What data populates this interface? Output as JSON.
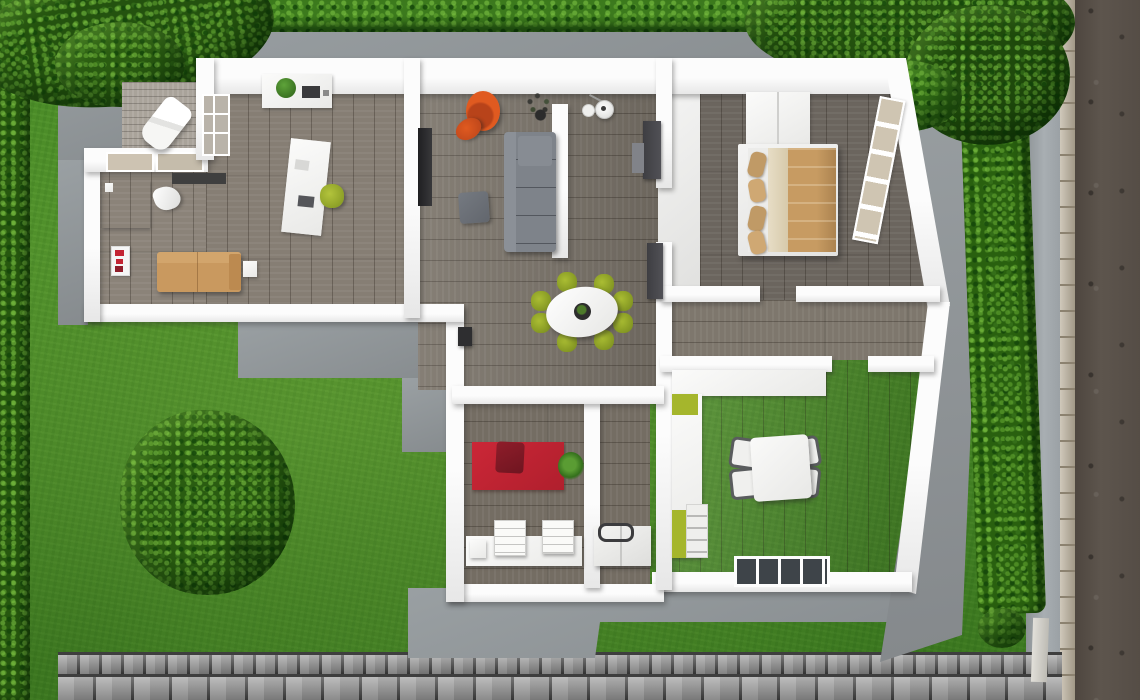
{
  "scene": {
    "kind": "3d-floor-plan-top-view"
  },
  "palette": {
    "grass": "#4b8c28",
    "hedge": "#2e6414",
    "tree": "#285a10",
    "patio": "#8f9497",
    "wall": "#f6f6f6",
    "wood_floor": "#7d7569",
    "wood_floor_dark": "#6b645c",
    "deck": "#a9a39a",
    "hall_floor": "#efefef",
    "road": "#564e47",
    "curb": "#b6ab96",
    "sidewalk": "#9da3a7",
    "cobblestone": "#949494",
    "accent_orange": "#d9561f",
    "accent_red": "#c32433",
    "accent_lime": "#a4b92c",
    "sofa_tan": "#c9995f",
    "bed_blanket": "#c79b62",
    "cabinet_dark": "#46464a",
    "rug_dark": "#3f3f3f"
  },
  "environment": {
    "items": [
      "lawn",
      "hedge-top",
      "hedge-left",
      "hedge-right",
      "tree-top-left",
      "tree-top-right",
      "round-tree",
      "shrub",
      "concrete-patio",
      "walkway",
      "cobblestone-path",
      "sidewalk",
      "curb",
      "road"
    ]
  },
  "rooms": [
    {
      "id": "office",
      "label": "office",
      "floor": "wood",
      "furniture": [
        "wall shelf with plant",
        "desk",
        "green desk chair",
        "bookshelf",
        "paper lounge chair",
        "door mat",
        "red wall poster",
        "tan sofa",
        "side table"
      ]
    },
    {
      "id": "terrace",
      "label": "terrace deck",
      "floor": "weathered wood",
      "furniture": [
        "sun lounger"
      ]
    },
    {
      "id": "living-room",
      "label": "living room",
      "floor": "wood",
      "furniture": [
        "tv panel",
        "orange armchair",
        "orange footstool",
        "twig plant",
        "floor lamp",
        "gray sofa",
        "ottoman",
        "room divider",
        "tall dark cabinets",
        "wall heater"
      ]
    },
    {
      "id": "dining-area",
      "label": "dining area",
      "floor": "wood",
      "furniture": [
        "oval white table",
        "eight lime chairs",
        "centerpiece plant"
      ]
    },
    {
      "id": "entry-hall",
      "label": "entry hall",
      "floor": "white tile",
      "furniture": []
    },
    {
      "id": "bedroom",
      "label": "bedroom",
      "floor": "wood",
      "furniture": [
        "wardrobe",
        "double bed with tan pillows and blanket",
        "window"
      ]
    },
    {
      "id": "corridor",
      "label": "corridor",
      "floor": "wood",
      "furniture": []
    },
    {
      "id": "kitchen-dining",
      "label": "kitchen dining room",
      "floor": "wood",
      "furniture": [
        "L-shaped counter with lime accents",
        "oven stack",
        "square table",
        "four chairs",
        "window"
      ]
    },
    {
      "id": "utility-room",
      "label": "utility room",
      "floor": "wood",
      "furniture": [
        "red rug",
        "dark red armchair",
        "potted plant",
        "white sideboard",
        "two drawer chests"
      ]
    },
    {
      "id": "storage-room",
      "label": "storage room",
      "floor": "wood",
      "furniture": [
        "white chest appliance with dark handle"
      ]
    }
  ]
}
